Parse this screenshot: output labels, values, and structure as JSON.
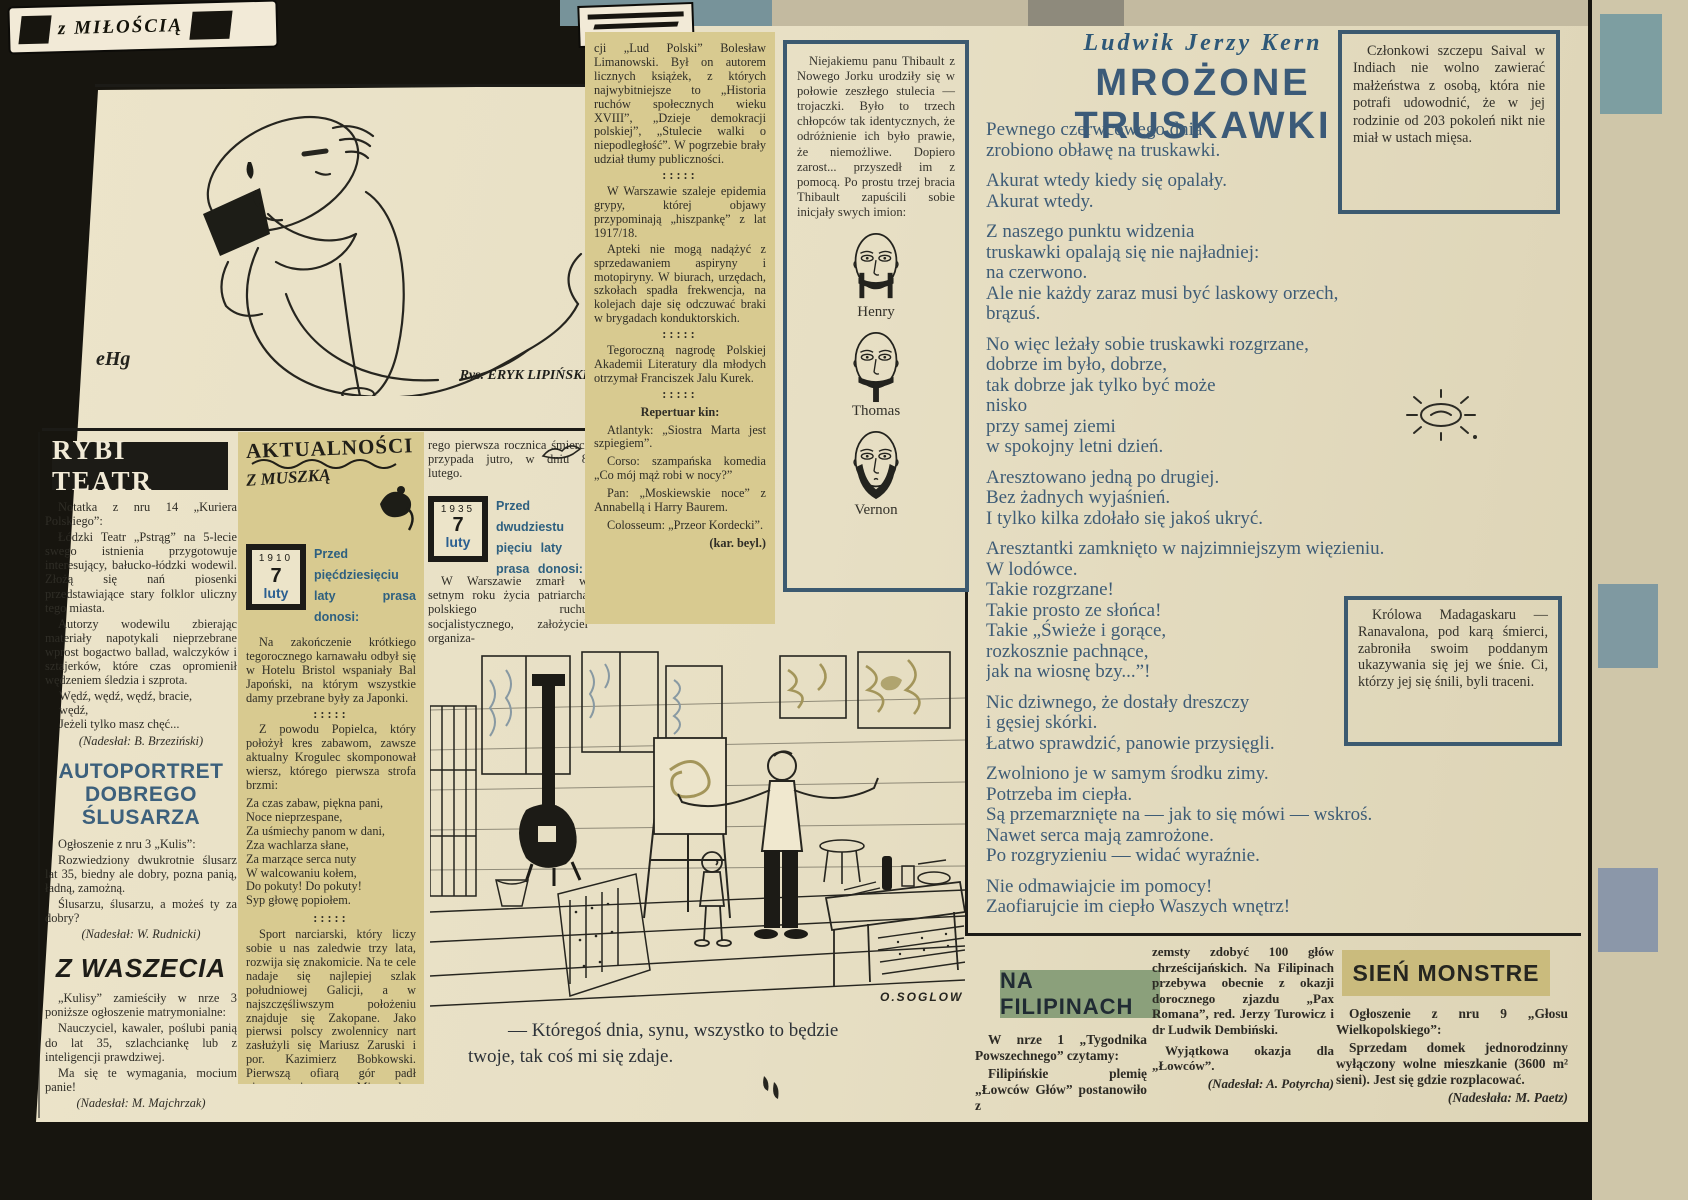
{
  "masthead": {
    "text": "z MIŁOŚCIĄ"
  },
  "top_cartoon": {
    "signature": "eHg",
    "caption": "Rys. ERYK LIPIŃSKI"
  },
  "left": {
    "rybi": {
      "title": "RYBI TEATR",
      "p1": "Notatka z nru 14 „Kuriera Polskiego”:",
      "p2": "Łódzki Teatr „Pstrąg” na 5-lecie swego istnienia przygotowuje interesujący, bałucko-łódzki wodewil. Złożą się nań piosenki przedstawiające stary folklor uliczny tego miasta.",
      "p3": "Autorzy wodewilu zbierając materiały napotykali nieprzebrane wprost bogactwo ballad, walczyków i sztajerków, które czas opromienił wędzeniem śledzia i szprota.",
      "verse": "Wędź, wędź, wędź, bracie,\nwędź,\nJeżeli tylko masz chęć...",
      "credit": "(Nadesłał: B. Brzeziński)"
    },
    "autoportret": {
      "title": "AUTOPORTRET\nDOBREGO\nŚLUSARZA",
      "p1": "Ogłoszenie z nru 3 „Kulis”:",
      "p2": "Rozwiedziony dwukrotnie ślusarz lat 35, biedny ale dobry, pozna panią, ładną, zamożną.",
      "p3": "Ślusarzu, ślusarzu, a możeś ty za dobry?",
      "credit": "(Nadesłał: W. Rudnicki)"
    },
    "waszecia": {
      "title": "Z WASZECIA",
      "p1": "„Kulisy” zamieściły w nrze 3 poniższe ogłoszenie matrymonialne:",
      "p2": "Nauczyciel, kawaler, poślubi panią do lat 35, szlachciankę lub z inteligencji prawdziwej.",
      "p3": "Ma się te wymagania, mocium panie!",
      "credit": "(Nadesłał: M. Majchrzak)"
    }
  },
  "aktualnosci": {
    "logo1": "AKTUALNOŚCI",
    "logo2": "Z MUSZKĄ",
    "cal1": {
      "year": "1910",
      "day": "7",
      "month": "luty"
    },
    "lead1": "Przed pięćdziesięciu laty prasa donosi:",
    "p1": "Na zakończenie krótkiego tegorocznego karnawału odbył się w Hotelu Bristol wspaniały Bal Japoński, na którym wszystkie damy przebrane były za Japonki.",
    "sep": ":::::",
    "p2": "Z powodu Popielca, który położył kres zabawom, zawsze aktualny Krogulec skomponował wiersz, którego pierwsza strofa brzmi:",
    "verse": "Za czas zabaw, piękna pani,\nNoce nieprzespane,\nZa uśmiechy panom w dani,\nZza wachlarza słane,\nZa marzące serca nuty\nW walcowaniu kołem,\nDo pokuty! Do pokuty!\nSyp głowę popiołem.",
    "p3": "Sport narciarski, który liczy sobie u nas zaledwie trzy lata, rozwija się znakomicie. Na te cele nadaje się najlepiej szlak południowej Galicji, a w najszczęśliwszym położeniu znajduje się Zakopane. Jako pierwsi polscy zwolennicy nart zasłużyli się Mariusz Zaruski i por. Kazimierz Bobkowski. Pierwszą ofiarą gór padł niezapomniany Mieczysław Karłowicz, któ-"
  },
  "col3": {
    "p0": "rego pierwsza rocznica śmierci przypada jutro, w dniu 8 lutego.",
    "cal2": {
      "year": "1935",
      "day": "7",
      "month": "luty"
    },
    "lead2": "Przed dwudziestu pięciu laty prasa donosi:",
    "p1": "W Warszawie zmarł w setnym roku życia patriarcha polskiego ruchu socjalistycznego, założyciel organiza-"
  },
  "strip": {
    "p1": "cji „Lud Polski” Bolesław Limanowski. Był on autorem licznych książek, z których najwybitniejsze to „Historia ruchów społecznych wieku XVIII”, „Dzieje demokracji polskiej”, „Stulecie walki o niepodległość”. W pogrzebie brały udział tłumy publiczności.",
    "sep": ":::::",
    "p2": "W Warszawie szaleje epidemia grypy, której objawy przypominają „hiszpankę” z lat 1917/18.",
    "p3": "Apteki nie mogą nadążyć z sprzedawaniem aspiryny i motopiryny. W biurach, urzędach, szkołach spadła frekwencja, na kolejach daje się odczuwać braki w brygadach konduktorskich.",
    "p4": "Tegoroczną nagrodę Polskiej Akademii Literatury dla młodych otrzymał Franciszek Jalu Kurek.",
    "repertuar_title": "Repertuar kin:",
    "kino1": "Atlantyk: „Siostra Marta jest szpiegiem”.",
    "kino2": "Corso: szampańska komedia „Co mój mąż robi w nocy?”",
    "kino3": "Pan: „Moskiewskie noce” z Annabellą i Harry Baurem.",
    "kino4": "Colosseum: „Przeor Kordecki”.",
    "credit": "(kar. beyl.)"
  },
  "thibault": {
    "text": "Niejakiemu panu Thibault z Nowego Jorku urodziły się w połowie zeszłego stulecia — trojaczki. Było to trzech chłopców tak identycznych, że odróżnienie ich było prawie, że niemożliwe. Dopiero zarost... przyszedł im z pomocą. Po prostu trzej bracia Thibault zapuścili sobie inicjały swych imion:",
    "names": [
      "Henry",
      "Thomas",
      "Vernon"
    ]
  },
  "poem": {
    "author": "Ludwik Jerzy Kern",
    "title": "MROŻONE TRUSKAWKI",
    "stanzas": [
      "Pewnego czerwcowego dnia\nzrobiono obławę na truskawki.",
      "Akurat wtedy kiedy się opalały.\nAkurat wtedy.",
      "Z naszego punktu widzenia\ntruskawki opalają się nie najładniej:\nna czerwono.\nAle nie każdy zaraz musi być laskowy orzech,\nbrązuś.",
      "No więc leżały sobie truskawki rozgrzane,\ndobrze im było, dobrze,\ntak dobrze jak tylko być może\nnisko\nprzy samej ziemi\nw spokojny letni dzień.",
      "Aresztowano jedną po drugiej.\nBez żadnych wyjaśnień.\nI tylko kilka zdołało się jakoś ukryć.",
      "Aresztantki zamknięto w najzimniejszym więzieniu.\nW lodówce.\nTakie rozgrzane!\nTakie prosto ze słońca!\nTakie „Świeże i gorące,\nrozkosznie pachnące,\njak na wiosnę bzy...”!",
      "Nic dziwnego, że dostały dreszczy\ni gęsiej skórki.\nŁatwo sprawdzić, panowie przysięgli.",
      "Zwolniono je w samym środku zimy.\nPotrzeba im ciepła.\nSą przemarznięte na — jak to się mówi — wskroś.\nNawet serca mają zamrożone.\nPo rozgryzieniu — widać wyraźnie.",
      "Nie odmawiajcie im pomocy!\nZaofiarujcie im ciepło Waszych wnętrz!"
    ]
  },
  "box_saival": {
    "text": "Członkowi szczepu Saival w Indiach nie wolno zawierać małżeństwa z osobą, która nie potrafi udowodnić, że w jej rodzinie od 203 pokoleń nikt nie miał w ustach mięsa."
  },
  "box_queen": {
    "text": "Królowa Madagaskaru — Ranavalona, pod karą śmierci, zabroniła swoim poddanym ukazywania się jej we śnie. Ci, którzy jej się śnili, byli traceni."
  },
  "bottom_cartoon": {
    "signature": "O.SOGLOW",
    "caption": "— Któregoś dnia, synu, wszystko to będzie\ntwoje, tak coś mi się zdaje."
  },
  "filipiny": {
    "title": "NA FILIPINACH",
    "p1": "W nrze 1 „Tygodnika Powszechnego” czytamy:",
    "p2": "Filipińskie plemię „Łowców Głów” postanowiło z",
    "p3": "zemsty zdobyć 100 głów chrześcijańskich. Na Filipinach przebywa obecnie z okazji dorocznego zjazdu „Pax Romana”, red. Jerzy Turowicz i dr Ludwik Dembiński.",
    "p4": "Wyjątkowa okazja dla „Łowców”.",
    "credit": "(Nadesłał: A. Potyrcha)"
  },
  "sien": {
    "title": "SIEŃ MONSTRE",
    "p1": "Ogłoszenie z nru 9 „Głosu Wielkopolskiego”:",
    "p2": "Sprzedam domek jednorodzinny wyłączony wolne mieszkanie (3600 m² sieni). Jest się gdzie rozplacować.",
    "credit": "(Nadesłała: M. Paetz)"
  },
  "colors": {
    "paper": "#e9e1c7",
    "tan_panel": "#d8ca90",
    "headline_blue": "#3b5a78",
    "poem_text": "#3e5c76",
    "banner_green": "#8ba07b",
    "banner_tan": "#cabb7d",
    "box_border": "#3c5a70",
    "ink": "#26251f"
  }
}
